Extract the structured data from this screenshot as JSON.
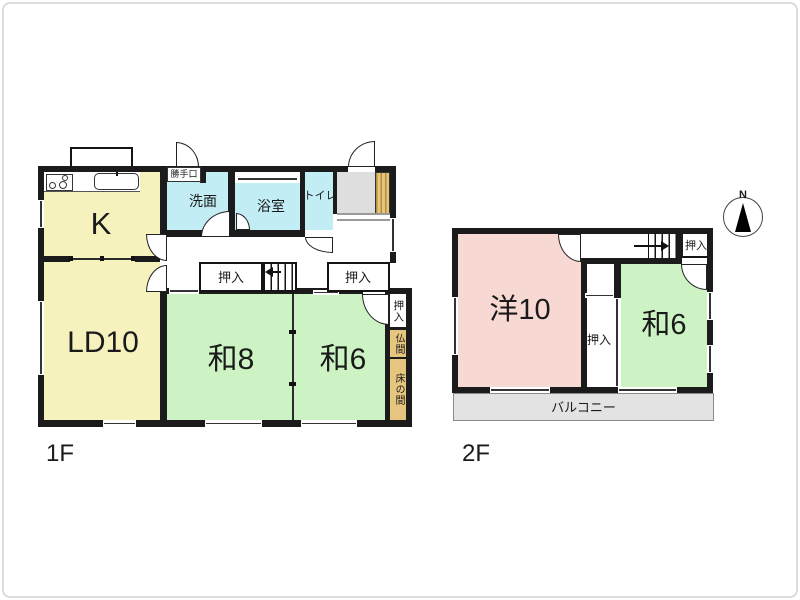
{
  "colors": {
    "wall": "#1b1b1b",
    "text": "#1a1a1a",
    "yellow": "#f6f2bd",
    "green": "#cdf3c5",
    "pink": "#f8d8d3",
    "cyan": "#c3edf5",
    "tan": "#e6c57e",
    "tan_stripe": "#b78c3f",
    "gray": "#dedede",
    "balcony": "#e3e3e3",
    "step_line": "#9a9a9a"
  },
  "floor1": {
    "label": "1F",
    "rooms": {
      "kitchen": "K",
      "living_dining": "LD10",
      "japanese_room_8": "和8",
      "japanese_room_6": "和6",
      "washroom": "洗面",
      "bathroom": "浴室",
      "toilet": "トイレ",
      "back_door": "勝手口",
      "closet_1": "押入",
      "closet_2": "押入",
      "closet_3": "押入",
      "buddhist_alcove": "仏間",
      "tokonoma": "床の間"
    }
  },
  "floor2": {
    "label": "2F",
    "rooms": {
      "western_room_10": "洋10",
      "japanese_room_6": "和6",
      "closet_hall": "押入",
      "closet_center": "押入",
      "balcony": "バルコニー"
    }
  },
  "compass": {
    "north": "N"
  }
}
